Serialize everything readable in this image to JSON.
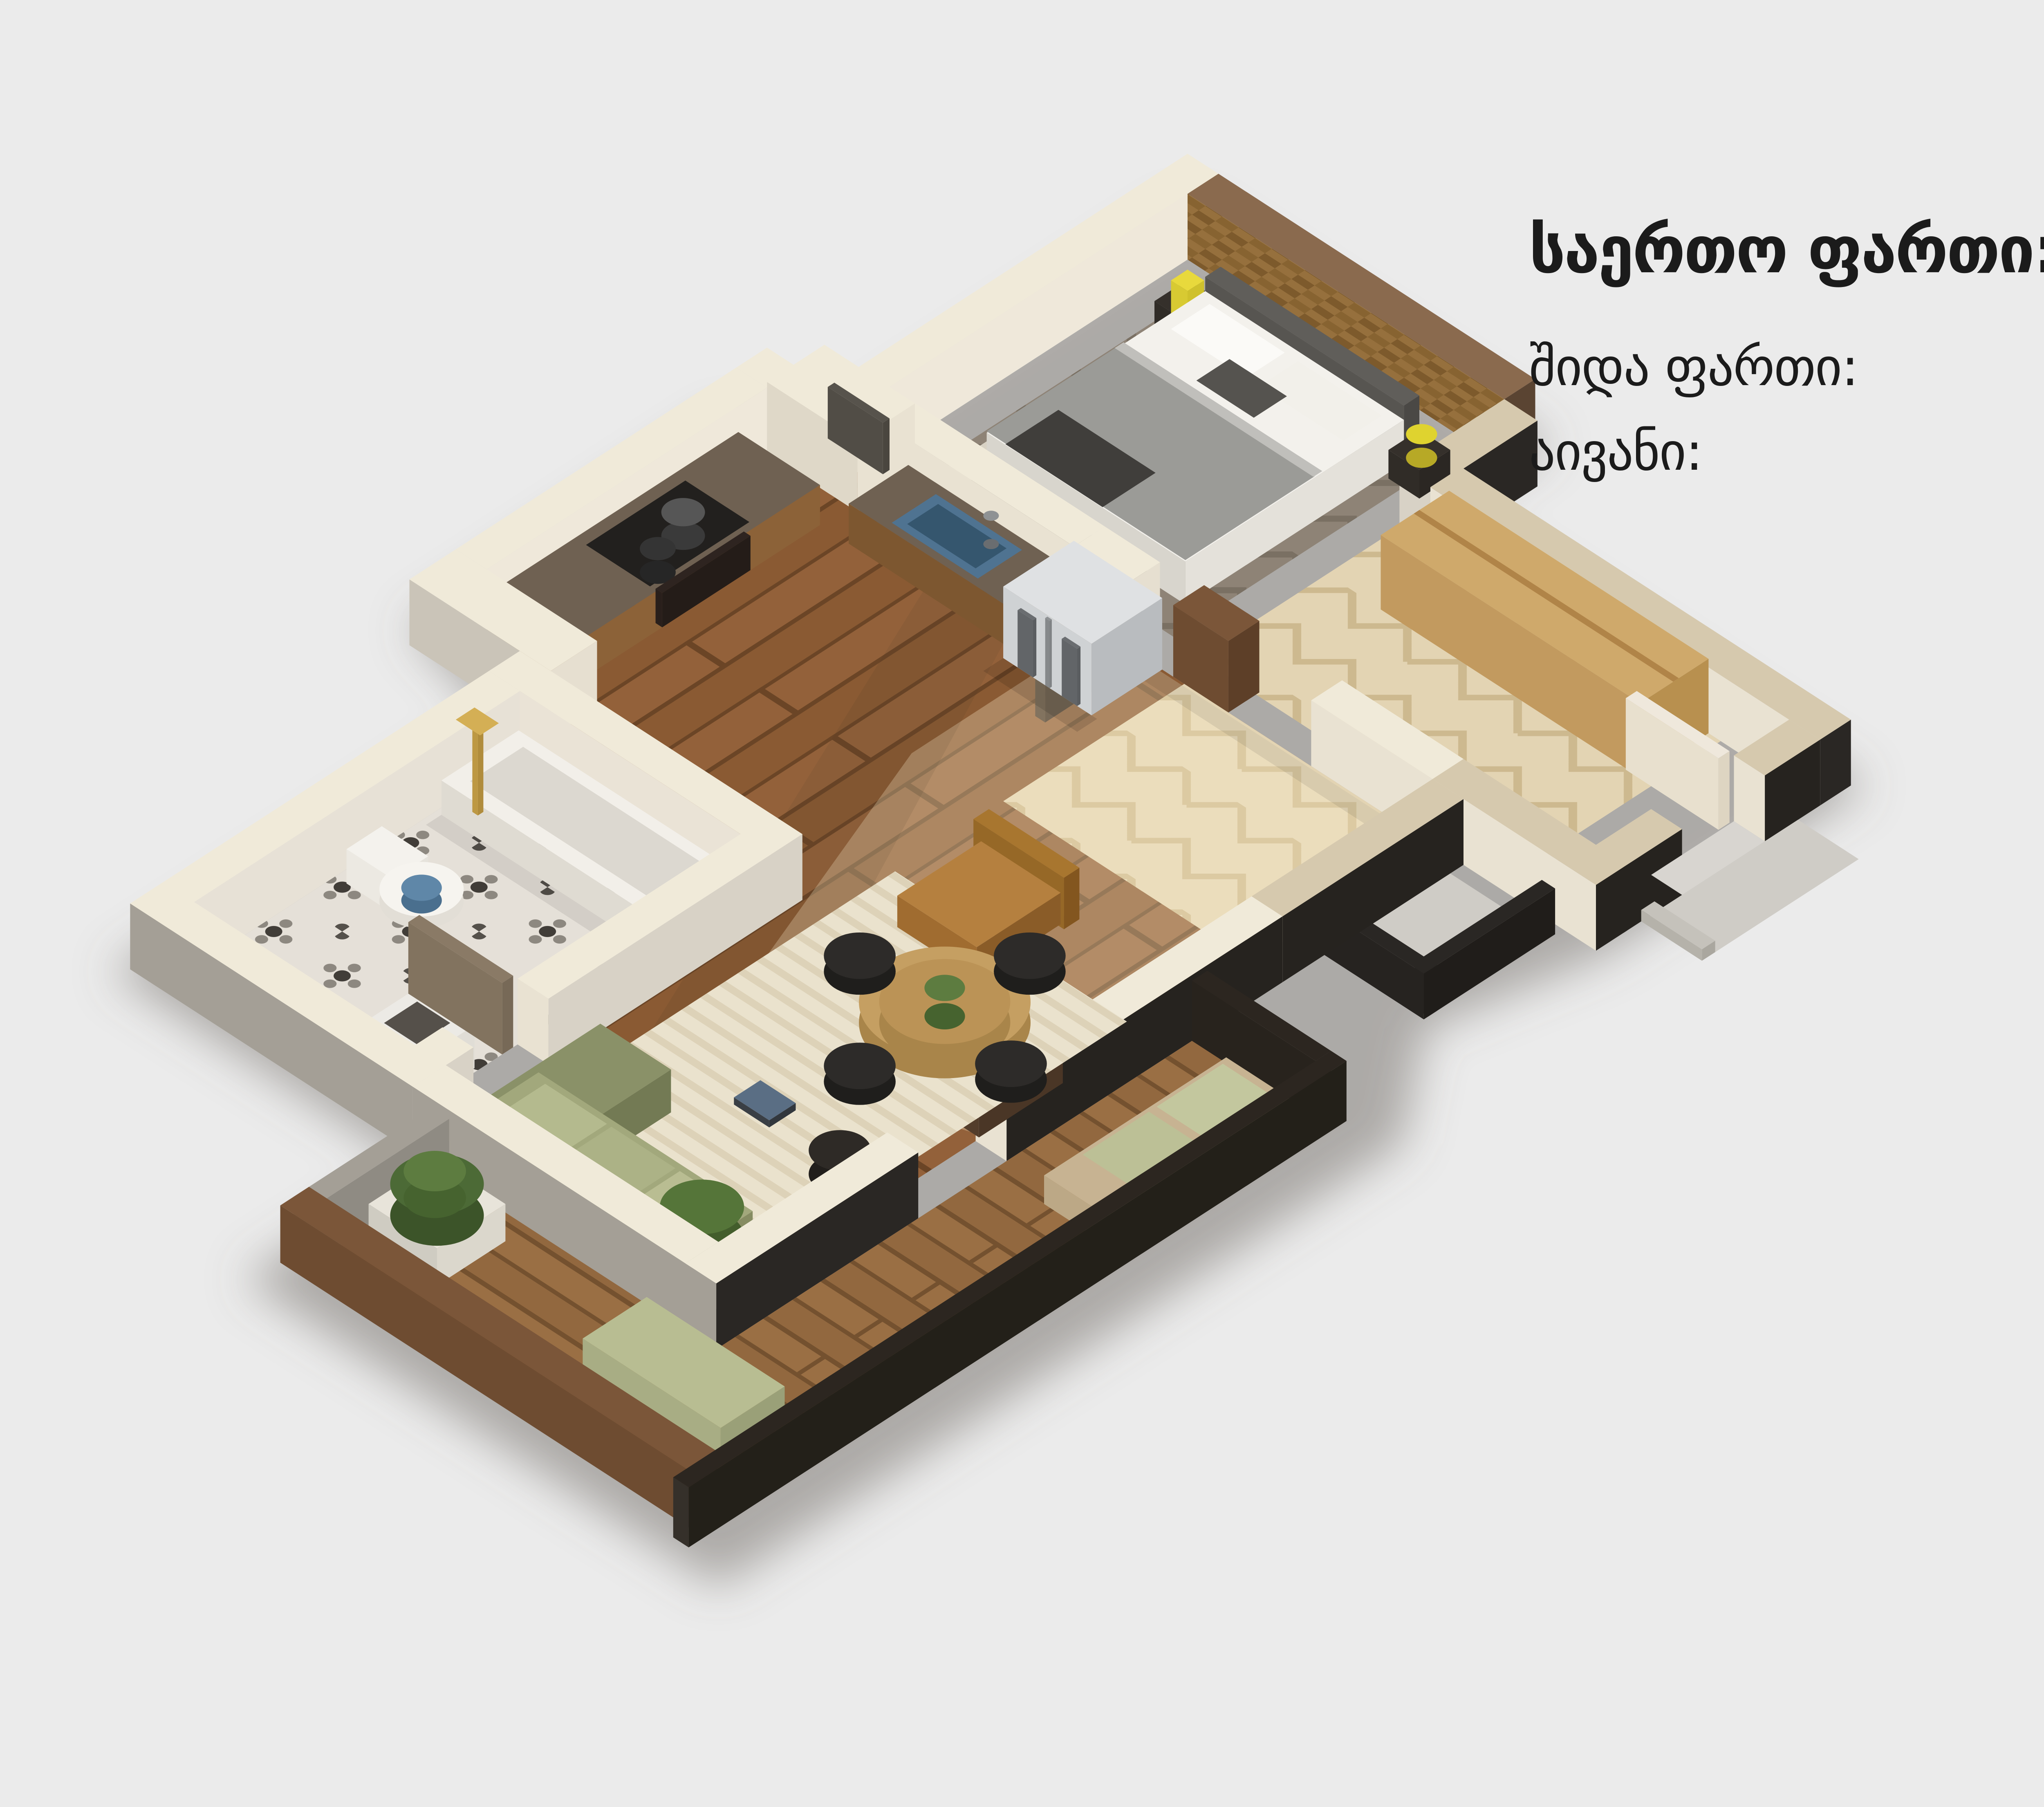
{
  "page": {
    "background_color": "#ebebeb",
    "text_color": "#1b1b1b"
  },
  "stats": {
    "title": {
      "label": "საერთო ფართი:",
      "value": "45.7",
      "unit": "მ",
      "sup": "2"
    },
    "rows": [
      {
        "label": "შიდა ფართი:",
        "value": "41.6",
        "unit": "მ",
        "sup": "2"
      },
      {
        "label": "აივანი:",
        "value": "4.1",
        "unit": "მ",
        "sup": "2"
      }
    ]
  },
  "floor_plan": {
    "type": "isometric-3d-apartment-render",
    "rooms": [
      "bedroom",
      "entry-hall",
      "kitchen",
      "living-room",
      "bathroom",
      "balcony"
    ],
    "palette": {
      "wall_top": "#f0ead9",
      "wall_stone_top": "#d6c9ae",
      "exterior_dark": "#26231f",
      "exterior_stone": "#a49f96",
      "wood_floor": "#8a5a33",
      "pale_herringbone": "#e2d3b2",
      "wicker_wall": "#96703d",
      "sofa_green": "#a2a87c",
      "armchair_tan": "#b5803f",
      "sink_blue": "#4f7391",
      "brass": "#c9a24a"
    }
  }
}
